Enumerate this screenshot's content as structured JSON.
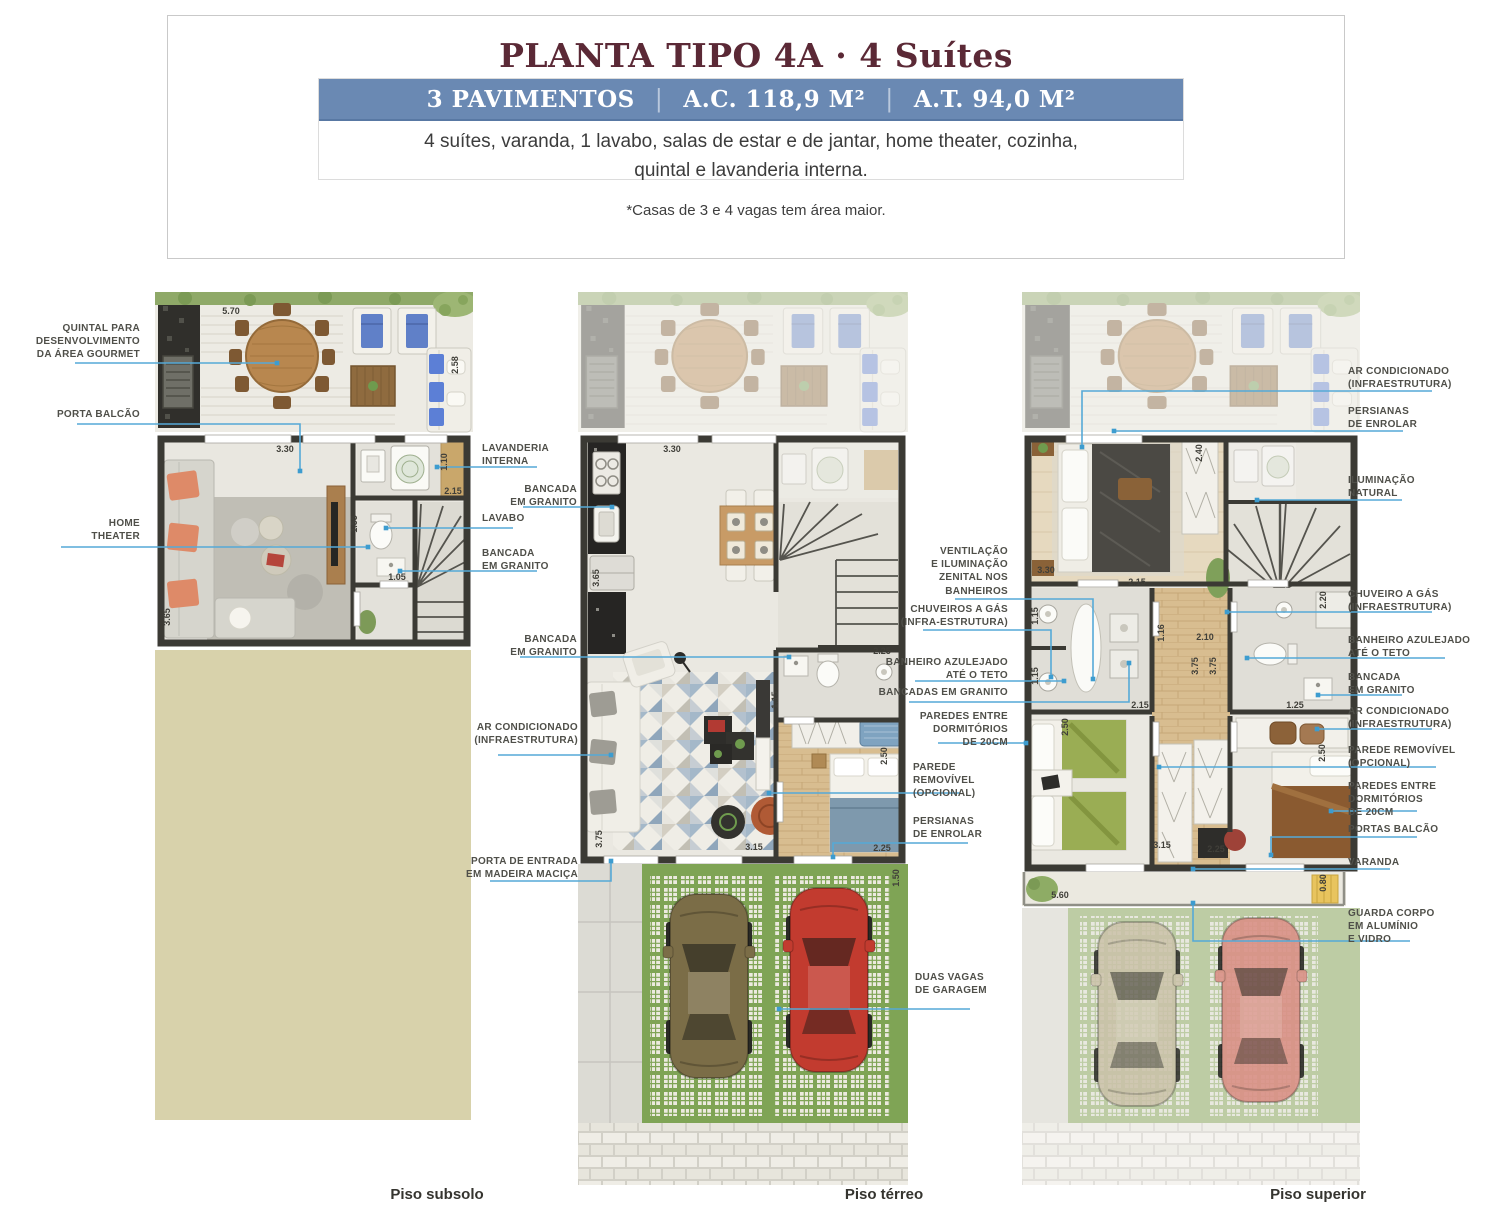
{
  "header": {
    "title": "PLANTA TIPO 4A · 4 Suítes",
    "banner": {
      "pavimentos": "3 PAVIMENTOS",
      "separator": "|",
      "ac": "A.C. 118,9 M²",
      "at": "A.T. 94,0 M²"
    },
    "description_line1": "4 suítes, varanda, 1 lavabo, salas de estar e de jantar, home theater, cozinha,",
    "description_line2": "quintal e lavanderia interna.",
    "note": "*Casas de 3 e 4 vagas tem área maior."
  },
  "floors": {
    "subsolo": "Piso subsolo",
    "terreo": "Piso térreo",
    "superior": "Piso superior"
  },
  "colors": {
    "title": "#5b2936",
    "banner": "#6a89b3",
    "leader_line": "#55a9d7",
    "label_text": "#4f4f49",
    "wall": "#3b3a34",
    "grass": "#7fa455",
    "terrain_beige": "#d8d2ab"
  },
  "annotations": {
    "labels": [
      {
        "text": "QUINTAL PARA\nDESENVOLVIMENTO\nDA ÁREA GOURMET",
        "x": 30,
        "y": 322,
        "w": 110,
        "align": "right",
        "leader": [
          [
            75,
            363
          ],
          [
            277,
            363
          ]
        ]
      },
      {
        "text": "PORTA BALCÃO",
        "x": 30,
        "y": 408,
        "w": 110,
        "align": "right",
        "leader": [
          [
            77,
            424
          ],
          [
            300,
            424
          ],
          [
            300,
            471
          ]
        ]
      },
      {
        "text": "HOME\nTHEATER",
        "x": 30,
        "y": 517,
        "w": 110,
        "align": "right",
        "leader": [
          [
            61,
            547
          ],
          [
            368,
            547
          ]
        ]
      },
      {
        "text": "LAVANDERIA\nINTERNA",
        "x": 482,
        "y": 442,
        "w": 95,
        "align": "left",
        "leader": [
          [
            537,
            467
          ],
          [
            437,
            467
          ]
        ]
      },
      {
        "text": "BANCADA\nEM GRANITO",
        "x": 477,
        "y": 483,
        "w": 100,
        "align": "right",
        "leader": [
          [
            523,
            507
          ],
          [
            612,
            507
          ]
        ]
      },
      {
        "text": "LAVABO",
        "x": 482,
        "y": 512,
        "w": 70,
        "align": "left",
        "leader": [
          [
            513,
            528
          ],
          [
            386,
            528
          ]
        ]
      },
      {
        "text": "BANCADA\nEM GRANITO",
        "x": 482,
        "y": 547,
        "w": 100,
        "align": "left",
        "leader": [
          [
            537,
            571
          ],
          [
            400,
            571
          ]
        ]
      },
      {
        "text": "BANCADA\nEM GRANITO",
        "x": 477,
        "y": 633,
        "w": 100,
        "align": "right",
        "leader": [
          [
            520,
            657
          ],
          [
            789,
            657
          ]
        ]
      },
      {
        "text": "AR CONDICIONADO\n(INFRAESTRUTURA)",
        "x": 458,
        "y": 721,
        "w": 120,
        "align": "right",
        "leader": [
          [
            498,
            755
          ],
          [
            611,
            755
          ]
        ]
      },
      {
        "text": "PORTA DE ENTRADA\nEM MADEIRA MACIÇA",
        "x": 448,
        "y": 855,
        "w": 130,
        "align": "right",
        "leader": [
          [
            490,
            881
          ],
          [
            611,
            881
          ],
          [
            611,
            861
          ]
        ]
      },
      {
        "text": "VENTILAÇÃO\nE ILUMINAÇÃO\nZENITAL NOS\nBANHEIROS",
        "x": 908,
        "y": 545,
        "w": 100,
        "align": "right",
        "leader": [
          [
            955,
            599
          ],
          [
            1093,
            599
          ],
          [
            1093,
            679
          ]
        ]
      },
      {
        "text": "CHUVEIROS A GÁS\n(INFRA-ESTRUTURA)",
        "x": 888,
        "y": 603,
        "w": 120,
        "align": "right",
        "leader": [
          [
            923,
            630
          ],
          [
            1051,
            630
          ],
          [
            1051,
            677
          ]
        ]
      },
      {
        "text": "BANHEIRO AZULEJADO\nATÉ O TETO",
        "x": 868,
        "y": 656,
        "w": 140,
        "align": "right",
        "leader": [
          [
            915,
            681
          ],
          [
            1064,
            681
          ]
        ]
      },
      {
        "text": "BANCADAS EM GRANITO",
        "x": 848,
        "y": 686,
        "w": 160,
        "align": "right",
        "leader": [
          [
            909,
            702
          ],
          [
            1129,
            702
          ],
          [
            1129,
            663
          ]
        ]
      },
      {
        "text": "PAREDES ENTRE\nDORMITÓRIOS\nDE 20CM",
        "x": 908,
        "y": 710,
        "w": 100,
        "align": "right",
        "leader": [
          [
            938,
            743
          ],
          [
            1026,
            743
          ]
        ]
      },
      {
        "text": "PAREDE\nREMOVÍVEL\n(OPCIONAL)",
        "x": 913,
        "y": 761,
        "w": 100,
        "align": "left",
        "leader": [
          [
            960,
            793
          ],
          [
            769,
            793
          ]
        ]
      },
      {
        "text": "PERSIANAS\nDE ENROLAR",
        "x": 913,
        "y": 815,
        "w": 100,
        "align": "left",
        "leader": [
          [
            968,
            843
          ],
          [
            833,
            843
          ],
          [
            833,
            857
          ]
        ]
      },
      {
        "text": "DUAS VAGAS\nDE GARAGEM",
        "x": 915,
        "y": 971,
        "w": 100,
        "align": "left",
        "leader": [
          [
            970,
            1009
          ],
          [
            779,
            1009
          ]
        ]
      },
      {
        "text": "AR CONDICIONADO\n(INFRAESTRUTURA)",
        "x": 1348,
        "y": 365,
        "w": 125,
        "align": "left",
        "leader": [
          [
            1432,
            391
          ],
          [
            1082,
            391
          ],
          [
            1082,
            447
          ]
        ]
      },
      {
        "text": "PERSIANAS\nDE ENROLAR",
        "x": 1348,
        "y": 405,
        "w": 110,
        "align": "left",
        "leader": [
          [
            1403,
            431
          ],
          [
            1114,
            431
          ]
        ]
      },
      {
        "text": "ILUMINAÇÃO\nNATURAL",
        "x": 1348,
        "y": 474,
        "w": 110,
        "align": "left",
        "leader": [
          [
            1402,
            500
          ],
          [
            1257,
            500
          ]
        ]
      },
      {
        "text": "CHUVEIRO A GÁS\n(INFRAESTRUTURA)",
        "x": 1348,
        "y": 588,
        "w": 125,
        "align": "left",
        "leader": [
          [
            1432,
            612
          ],
          [
            1227,
            612
          ]
        ]
      },
      {
        "text": "BANHEIRO AZULEJADO\nATÉ O TETO",
        "x": 1348,
        "y": 634,
        "w": 140,
        "align": "left",
        "leader": [
          [
            1445,
            658
          ],
          [
            1247,
            658
          ]
        ]
      },
      {
        "text": "BANCADA\nEM GRANITO",
        "x": 1348,
        "y": 671,
        "w": 110,
        "align": "left",
        "leader": [
          [
            1402,
            695
          ],
          [
            1318,
            695
          ]
        ]
      },
      {
        "text": "AR CONDICIONADO\n(INFRAESTRUTURA)",
        "x": 1348,
        "y": 705,
        "w": 125,
        "align": "left",
        "leader": [
          [
            1432,
            729
          ],
          [
            1317,
            729
          ]
        ]
      },
      {
        "text": "PAREDE REMOVÍVEL\n(OPCIONAL)",
        "x": 1348,
        "y": 744,
        "w": 130,
        "align": "left",
        "leader": [
          [
            1436,
            767
          ],
          [
            1159,
            767
          ]
        ]
      },
      {
        "text": "PAREDES ENTRE\nDORMITÓRIOS\nDE 20CM",
        "x": 1348,
        "y": 780,
        "w": 110,
        "align": "left",
        "leader": [
          [
            1417,
            811
          ],
          [
            1331,
            811
          ]
        ]
      },
      {
        "text": "PORTAS BALCÃO",
        "x": 1348,
        "y": 823,
        "w": 110,
        "align": "left",
        "leader": [
          [
            1417,
            837
          ],
          [
            1271,
            837
          ],
          [
            1271,
            855
          ]
        ]
      },
      {
        "text": "VARANDA",
        "x": 1348,
        "y": 856,
        "w": 90,
        "align": "left",
        "leader": [
          [
            1390,
            869
          ],
          [
            1193,
            869
          ]
        ]
      },
      {
        "text": "GUARDA CORPO\nEM ALUMÍNIO\nE VIDRO",
        "x": 1348,
        "y": 907,
        "w": 110,
        "align": "left",
        "leader": [
          [
            1410,
            941
          ],
          [
            1193,
            941
          ],
          [
            1193,
            903
          ]
        ]
      }
    ],
    "dimensions": [
      {
        "t": "5.70",
        "x": 231,
        "y": 311,
        "rot": 0
      },
      {
        "t": "2.58",
        "x": 455,
        "y": 365,
        "rot": 1
      },
      {
        "t": "3.30",
        "x": 285,
        "y": 449,
        "rot": 0
      },
      {
        "t": "1.10",
        "x": 444,
        "y": 462,
        "rot": 1
      },
      {
        "t": "2.15",
        "x": 453,
        "y": 491,
        "rot": 0
      },
      {
        "t": "1.55",
        "x": 354,
        "y": 524,
        "rot": 1
      },
      {
        "t": "1.05",
        "x": 397,
        "y": 577,
        "rot": 0
      },
      {
        "t": "3.65",
        "x": 167,
        "y": 617,
        "rot": 1
      },
      {
        "t": "3.30",
        "x": 672,
        "y": 449,
        "rot": 0
      },
      {
        "t": "3.65",
        "x": 596,
        "y": 578,
        "rot": 1
      },
      {
        "t": "2.25",
        "x": 882,
        "y": 651,
        "rot": 0
      },
      {
        "t": "1.15",
        "x": 775,
        "y": 700,
        "rot": 1
      },
      {
        "t": "2.50",
        "x": 884,
        "y": 756,
        "rot": 1
      },
      {
        "t": "3.75",
        "x": 599,
        "y": 839,
        "rot": 1
      },
      {
        "t": "3.15",
        "x": 754,
        "y": 847,
        "rot": 0
      },
      {
        "t": "2.25",
        "x": 882,
        "y": 848,
        "rot": 0
      },
      {
        "t": "1.50",
        "x": 896,
        "y": 878,
        "rot": 1
      },
      {
        "t": "2.40",
        "x": 1199,
        "y": 453,
        "rot": 1
      },
      {
        "t": "3.30",
        "x": 1046,
        "y": 570,
        "rot": 0
      },
      {
        "t": "2.15",
        "x": 1137,
        "y": 582,
        "rot": 0
      },
      {
        "t": "1.15",
        "x": 1035,
        "y": 616,
        "rot": 1
      },
      {
        "t": "1.15",
        "x": 1035,
        "y": 676,
        "rot": 1
      },
      {
        "t": "2.15",
        "x": 1140,
        "y": 705,
        "rot": 0
      },
      {
        "t": "1.16",
        "x": 1161,
        "y": 633,
        "rot": 1
      },
      {
        "t": "2.10",
        "x": 1205,
        "y": 637,
        "rot": 0
      },
      {
        "t": "3.75",
        "x": 1195,
        "y": 666,
        "rot": 1
      },
      {
        "t": "3.75",
        "x": 1213,
        "y": 666,
        "rot": 1
      },
      {
        "t": "2.20",
        "x": 1323,
        "y": 600,
        "rot": 1
      },
      {
        "t": "1.25",
        "x": 1295,
        "y": 705,
        "rot": 0
      },
      {
        "t": "2.50",
        "x": 1065,
        "y": 727,
        "rot": 1
      },
      {
        "t": "2.50",
        "x": 1322,
        "y": 753,
        "rot": 1
      },
      {
        "t": "3.15",
        "x": 1162,
        "y": 845,
        "rot": 0
      },
      {
        "t": "2.25",
        "x": 1216,
        "y": 849,
        "rot": 0
      },
      {
        "t": "5.60",
        "x": 1060,
        "y": 895,
        "rot": 0
      },
      {
        "t": "0.80",
        "x": 1323,
        "y": 883,
        "rot": 1
      }
    ]
  }
}
